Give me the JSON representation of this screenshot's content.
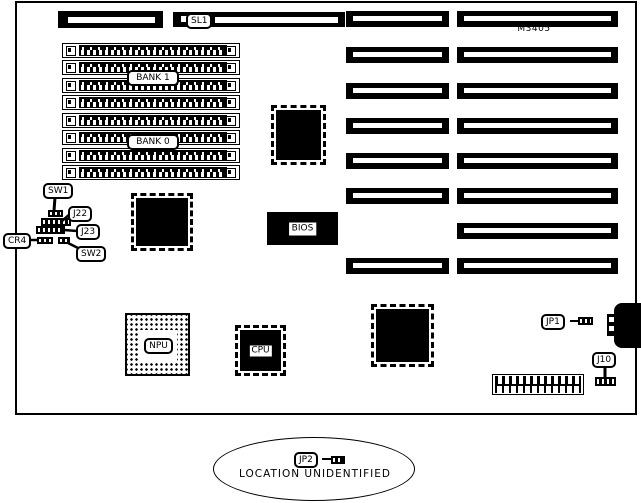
{
  "diagram": {
    "title": "motherboard layout diagram",
    "model_label": "M3405",
    "sl1_label": "SL1",
    "memory": {
      "bank1": "BANK 1",
      "bank0": "BANK 0"
    },
    "chips": {
      "bios": "BIOS",
      "npu": "NPU",
      "cpu": "CPU"
    },
    "jumpers": {
      "sw1": "SW1",
      "j22": "J22",
      "j23": "J23",
      "cr4": "CR4",
      "sw2": "SW2",
      "jp1": "JP1",
      "j10": "J10"
    },
    "note": {
      "label": "JP2",
      "text": "LOCATION UNIDENTIFIED"
    },
    "colors": {
      "ink": "#000000",
      "paper": "#ffffff"
    }
  }
}
